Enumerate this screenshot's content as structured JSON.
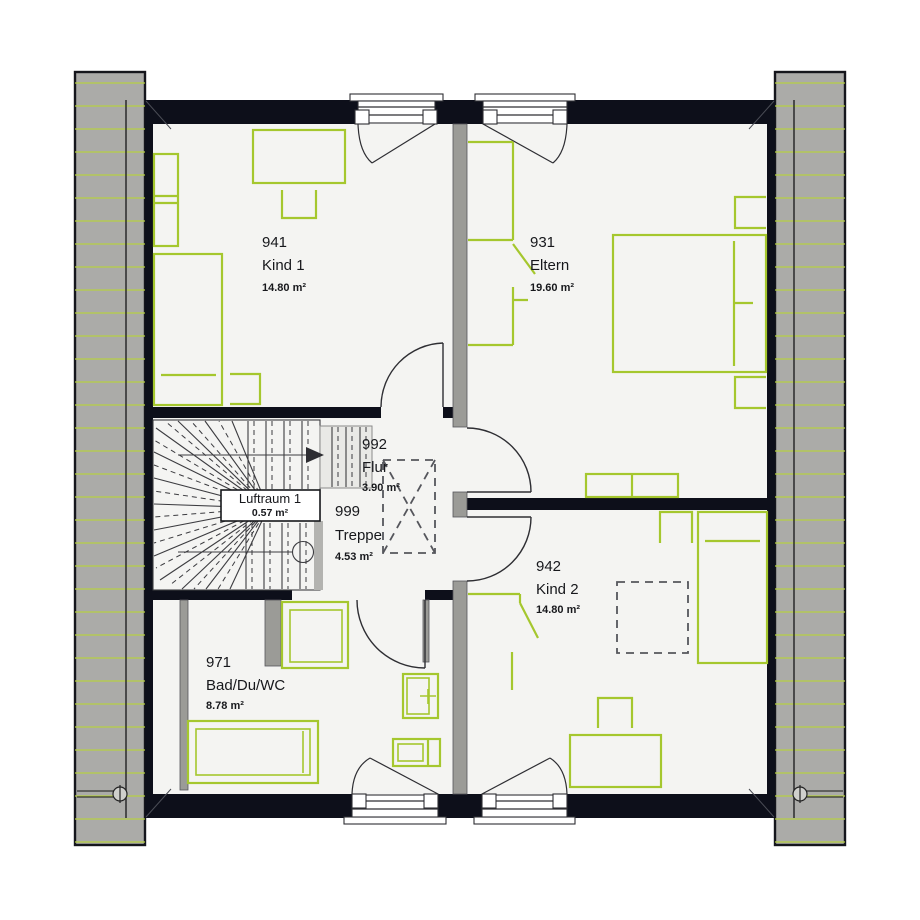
{
  "plan": {
    "rooms": [
      {
        "id": "941",
        "name": "Kind 1",
        "area": "14.80 m²"
      },
      {
        "id": "931",
        "name": "Eltern",
        "area": "19.60 m²"
      },
      {
        "id": "992",
        "name": "Flur",
        "area": "3.90 m²"
      },
      {
        "id": "999",
        "name": "Treppe",
        "area": "4.53 m²"
      },
      {
        "id": "971",
        "name": "Bad/Du/WC",
        "area": "8.78 m²"
      },
      {
        "id": "942",
        "name": "Kind 2",
        "area": "14.80 m²"
      }
    ],
    "luftraum": {
      "name": "Luftraum 1",
      "area": "0.57 m²"
    },
    "colors": {
      "furniture": "#a5c72e",
      "hatch": "#b7cf43",
      "wall": "#0d0f1a",
      "roof": "#ababa8",
      "floor": "#f4f4f2"
    }
  }
}
